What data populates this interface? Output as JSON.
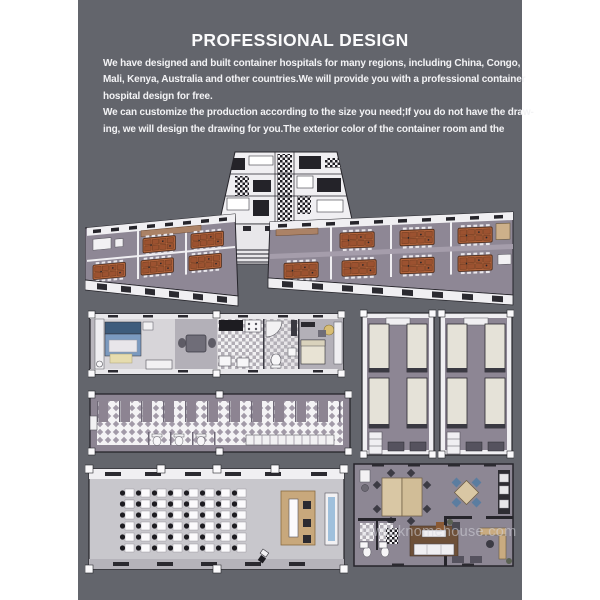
{
  "colors": {
    "page_bg": "#ffffff",
    "panel_bg": "#63656c",
    "text_white": "#f3f3f5",
    "furniture_orange": "#b2643c",
    "floor_mauve": "#8d8694",
    "wall_white": "#f0eff2",
    "wood_tan": "#c8a87c",
    "bed_blue": "#7b9ac0",
    "watermark_gray": "#d6d6dc"
  },
  "header": {
    "title": "PROFESSIONAL DESIGN"
  },
  "body_text": {
    "lines": [
      "We have designed and built container hospitals for many regions, including China, Congo,",
      "Mali, Kenya, Australia and other countries.We will provide you with a professional container",
      "hospital design for free.",
      "We can customize the production according to the size you need;If you do not have the draw-",
      "ing, we will design the drawing for you.The exterior color of the container room and the"
    ]
  },
  "watermark": {
    "text": "www.knomehouse.com"
  }
}
